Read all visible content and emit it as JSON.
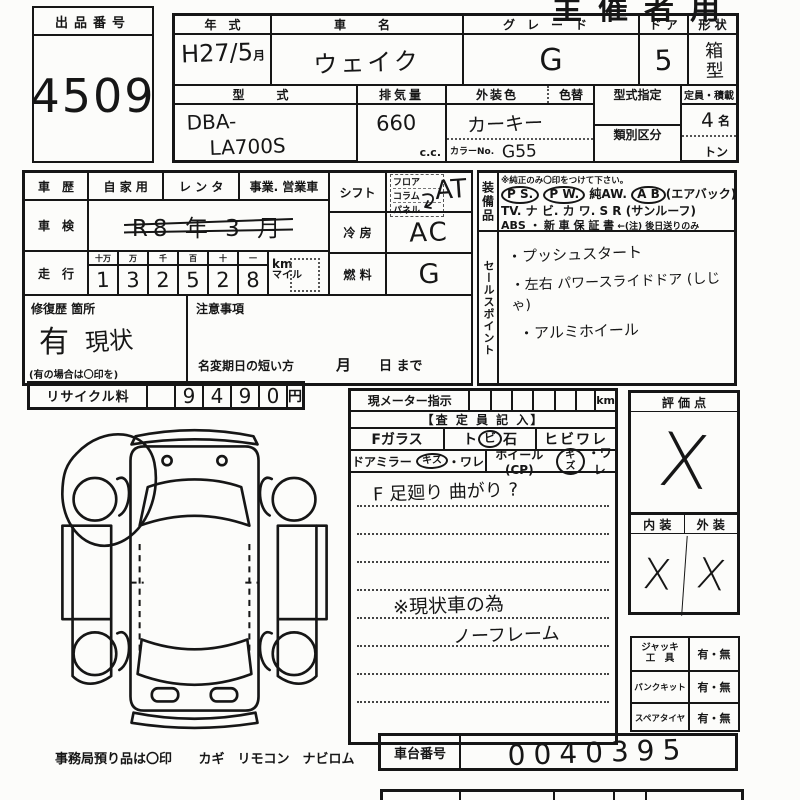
{
  "meta": {
    "doc_type": "vehicle-auction-inspection-sheet",
    "colors": {
      "paper": "#fcfcfa",
      "ink": "#161616"
    },
    "corner_header": "主催者用"
  },
  "lot": {
    "label": "出品番号",
    "value": "4509"
  },
  "top": {
    "year_label": "年　式",
    "year_value": "H27/5",
    "year_suffix": "月",
    "name_label": "車　名",
    "name_value": "ウェイク",
    "grade_label": "グレード",
    "grade_value": "G",
    "door_label": "ド ア",
    "door_value": "5",
    "shape_label": "形 状",
    "shape_value": "箱型",
    "model_label": "型　式",
    "model_line1": "DBA-",
    "model_line2": "LA700S",
    "disp_label": "排気量",
    "disp_value": "660",
    "disp_unit": "c.c.",
    "color_label": "外装色",
    "color_change_label": "色替",
    "color_value": "カーキー",
    "color_no_label": "カラーNo.",
    "color_no_value": "G55",
    "type_desig_label": "型式指定",
    "class_label": "類別区分",
    "capacity_label": "定員・積載",
    "capacity_value": "4",
    "capacity_unit": "名",
    "ton_label": "トン"
  },
  "history": {
    "label": "車　歴",
    "opt1": "自 家 用",
    "opt2": "レ ン タ",
    "opt3": "事業. 営業車"
  },
  "inspection": {
    "label": "車　検",
    "value": "R8 年 3 月"
  },
  "mileage": {
    "label": "走　行",
    "place_headers": [
      "十万",
      "万",
      "千",
      "百",
      "十",
      "一"
    ],
    "digits": [
      "1",
      "3",
      "2",
      "5",
      "2",
      "8"
    ],
    "unit_km": "km",
    "unit_mile": "マイル"
  },
  "repair": {
    "label": "修復歴 箇所",
    "value1": "有",
    "value2": "現状",
    "note": "(有の場合は〇印を)"
  },
  "caution": {
    "label": "注意事項",
    "deadline": "名変期日の短い方",
    "month": "月",
    "until": "日 まで"
  },
  "shift": {
    "label": "シフト",
    "opt1": "フロア",
    "opt2": "コラム",
    "opt3": "パネル",
    "value": "AT"
  },
  "aircon": {
    "label": "冷 房",
    "value": "AC"
  },
  "fuel": {
    "label": "燃 料",
    "value": "G"
  },
  "equipment": {
    "side_label": "装備品",
    "note": "※純正のみ〇印をつけて下さい。",
    "tok_ps": "P S.",
    "tok_pw": "P W.",
    "tok_aw": "純AW.",
    "tok_ab": "A B",
    "tok_ab_note": "(エアバック)",
    "row2": "TV. ナ ビ. カ ワ. S R (サンルーフ)",
    "row3_abs": "ABS ・",
    "row3_warranty": "新 車 保 証 書",
    "row3_note": "←(注) 後日送りのみ"
  },
  "sales": {
    "side_label": "セールスポイント",
    "item1": "・プッシュスタート",
    "item2": "・左右 パワースライドドア (しじゃ)",
    "item3": "・アルミホイール"
  },
  "recycle": {
    "label": "リサイクル料",
    "digits": [
      "9",
      "4",
      "9",
      "0"
    ],
    "unit": "円"
  },
  "meter": {
    "label": "現メーター指示",
    "unit": "km"
  },
  "inspector": {
    "header": "【査 定 員 記 入】",
    "glass": "Fガラス",
    "chip_pre": "ト",
    "chip_circled": "ビ",
    "chip_post": "石",
    "crack": "ヒビワレ",
    "mirror_label": "ドアミラー",
    "mirror_circled": "キズ",
    "mirror_rest": "・ワレ",
    "wheel_label": "ホイール(CP)",
    "wheel_circled": "キズ",
    "wheel_rest": "・ワレ",
    "note1": "F 足廻り 曲がり ?",
    "note2": "※現状車の為",
    "note3": "ノーフレーム"
  },
  "evaluation": {
    "label": "評 価 点",
    "value": "X",
    "interior_label": "内 装",
    "exterior_label": "外 装",
    "interior_value": "X",
    "exterior_value": "X"
  },
  "accessories": [
    {
      "l1": "ジャッキ",
      "l2": "工　具",
      "value": "有・無"
    },
    {
      "l1": "パンクキット",
      "l2": "",
      "value": "有・無"
    },
    {
      "l1": "スペアタイヤ",
      "l2": "",
      "value": "有・無"
    }
  ],
  "chassis": {
    "label": "車台番号",
    "value": "0040395"
  },
  "footer": {
    "office_note": "事務局預り品は〇印",
    "items": "カギ　リモコン　ナビロム"
  }
}
